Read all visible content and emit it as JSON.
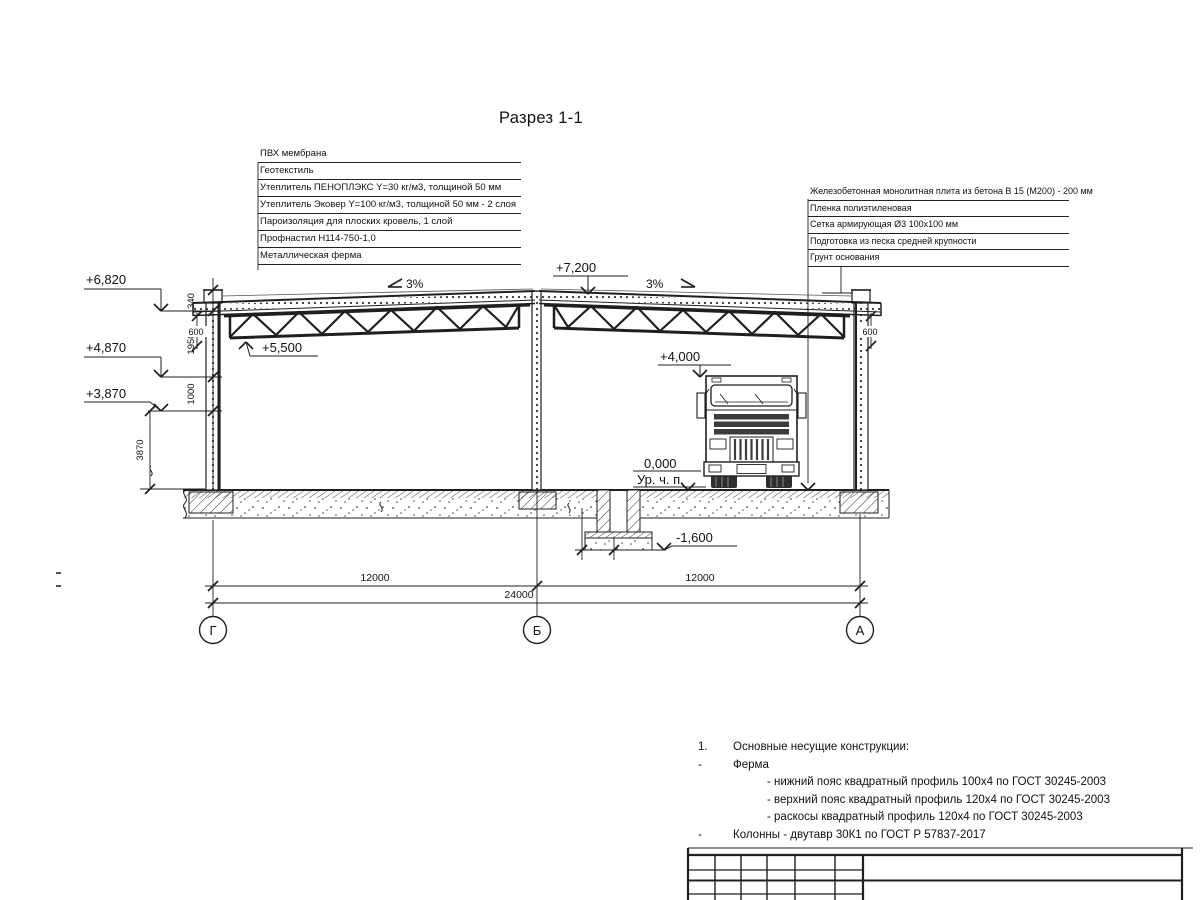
{
  "title": "Разрез 1-1",
  "roof_layers": [
    "ПВХ мембрана",
    "Геотекстиль",
    "Утеплитель ПЕНОПЛЭКС Y=30 кг/м3, толщиной 50 мм",
    "Утеплитель Эковер Y=100 кг/м3, толщиной 50 мм - 2 слоя",
    "Пароизоляция для плоских кровель, 1 слой",
    "Профнастил Н114-750-1,0",
    "Металлическая ферма"
  ],
  "floor_layers": [
    "Железобетонная монолитная плита из бетона В 15 (М200) - 200 мм",
    "Пленка полиэтиленовая",
    "Сетка армирующая Ø3 100х100 мм",
    "Подготовка из песка средней крупности",
    "Грунт основания"
  ],
  "elevations": {
    "parapet_left": "+6,820",
    "truss_support": "+4,870",
    "wall_mark": "+3,870",
    "ridge": "+7,200",
    "truss_bottom": "+5,500",
    "clearance": "+4,000",
    "floor_zero": "0,000",
    "floor_label": "Ур. ч. п.",
    "pit_bottom": "-1,600"
  },
  "slopes": {
    "left": "3%",
    "right": "3%"
  },
  "dims": {
    "v340": "340",
    "v1950": "1950",
    "v1000": "1000",
    "v3870": "3870",
    "left600": "600",
    "right600": "600",
    "span1": "12000",
    "span2": "12000",
    "total": "24000"
  },
  "axes": {
    "a1": "Г",
    "a2": "Б",
    "a3": "А"
  },
  "notes": {
    "num": "1.",
    "heading": "Основные несущие конструкции:",
    "dash1": "-",
    "item1": "Ферма",
    "sub1": "- нижний пояс квадратный профиль 100х4 по ГОСТ 30245-2003",
    "sub2": "- верхний пояс квадратный профиль 120х4 по ГОСТ 30245-2003",
    "sub3": "- раскосы квадратный профиль 120х4 по ГОСТ 30245-2003",
    "dash2": "-",
    "item2": "Колонны - двутавр 30К1 по ГОСТ Р 57837-2017"
  },
  "colors": {
    "ink": "#1f1f1f",
    "paper": "#ffffff"
  }
}
